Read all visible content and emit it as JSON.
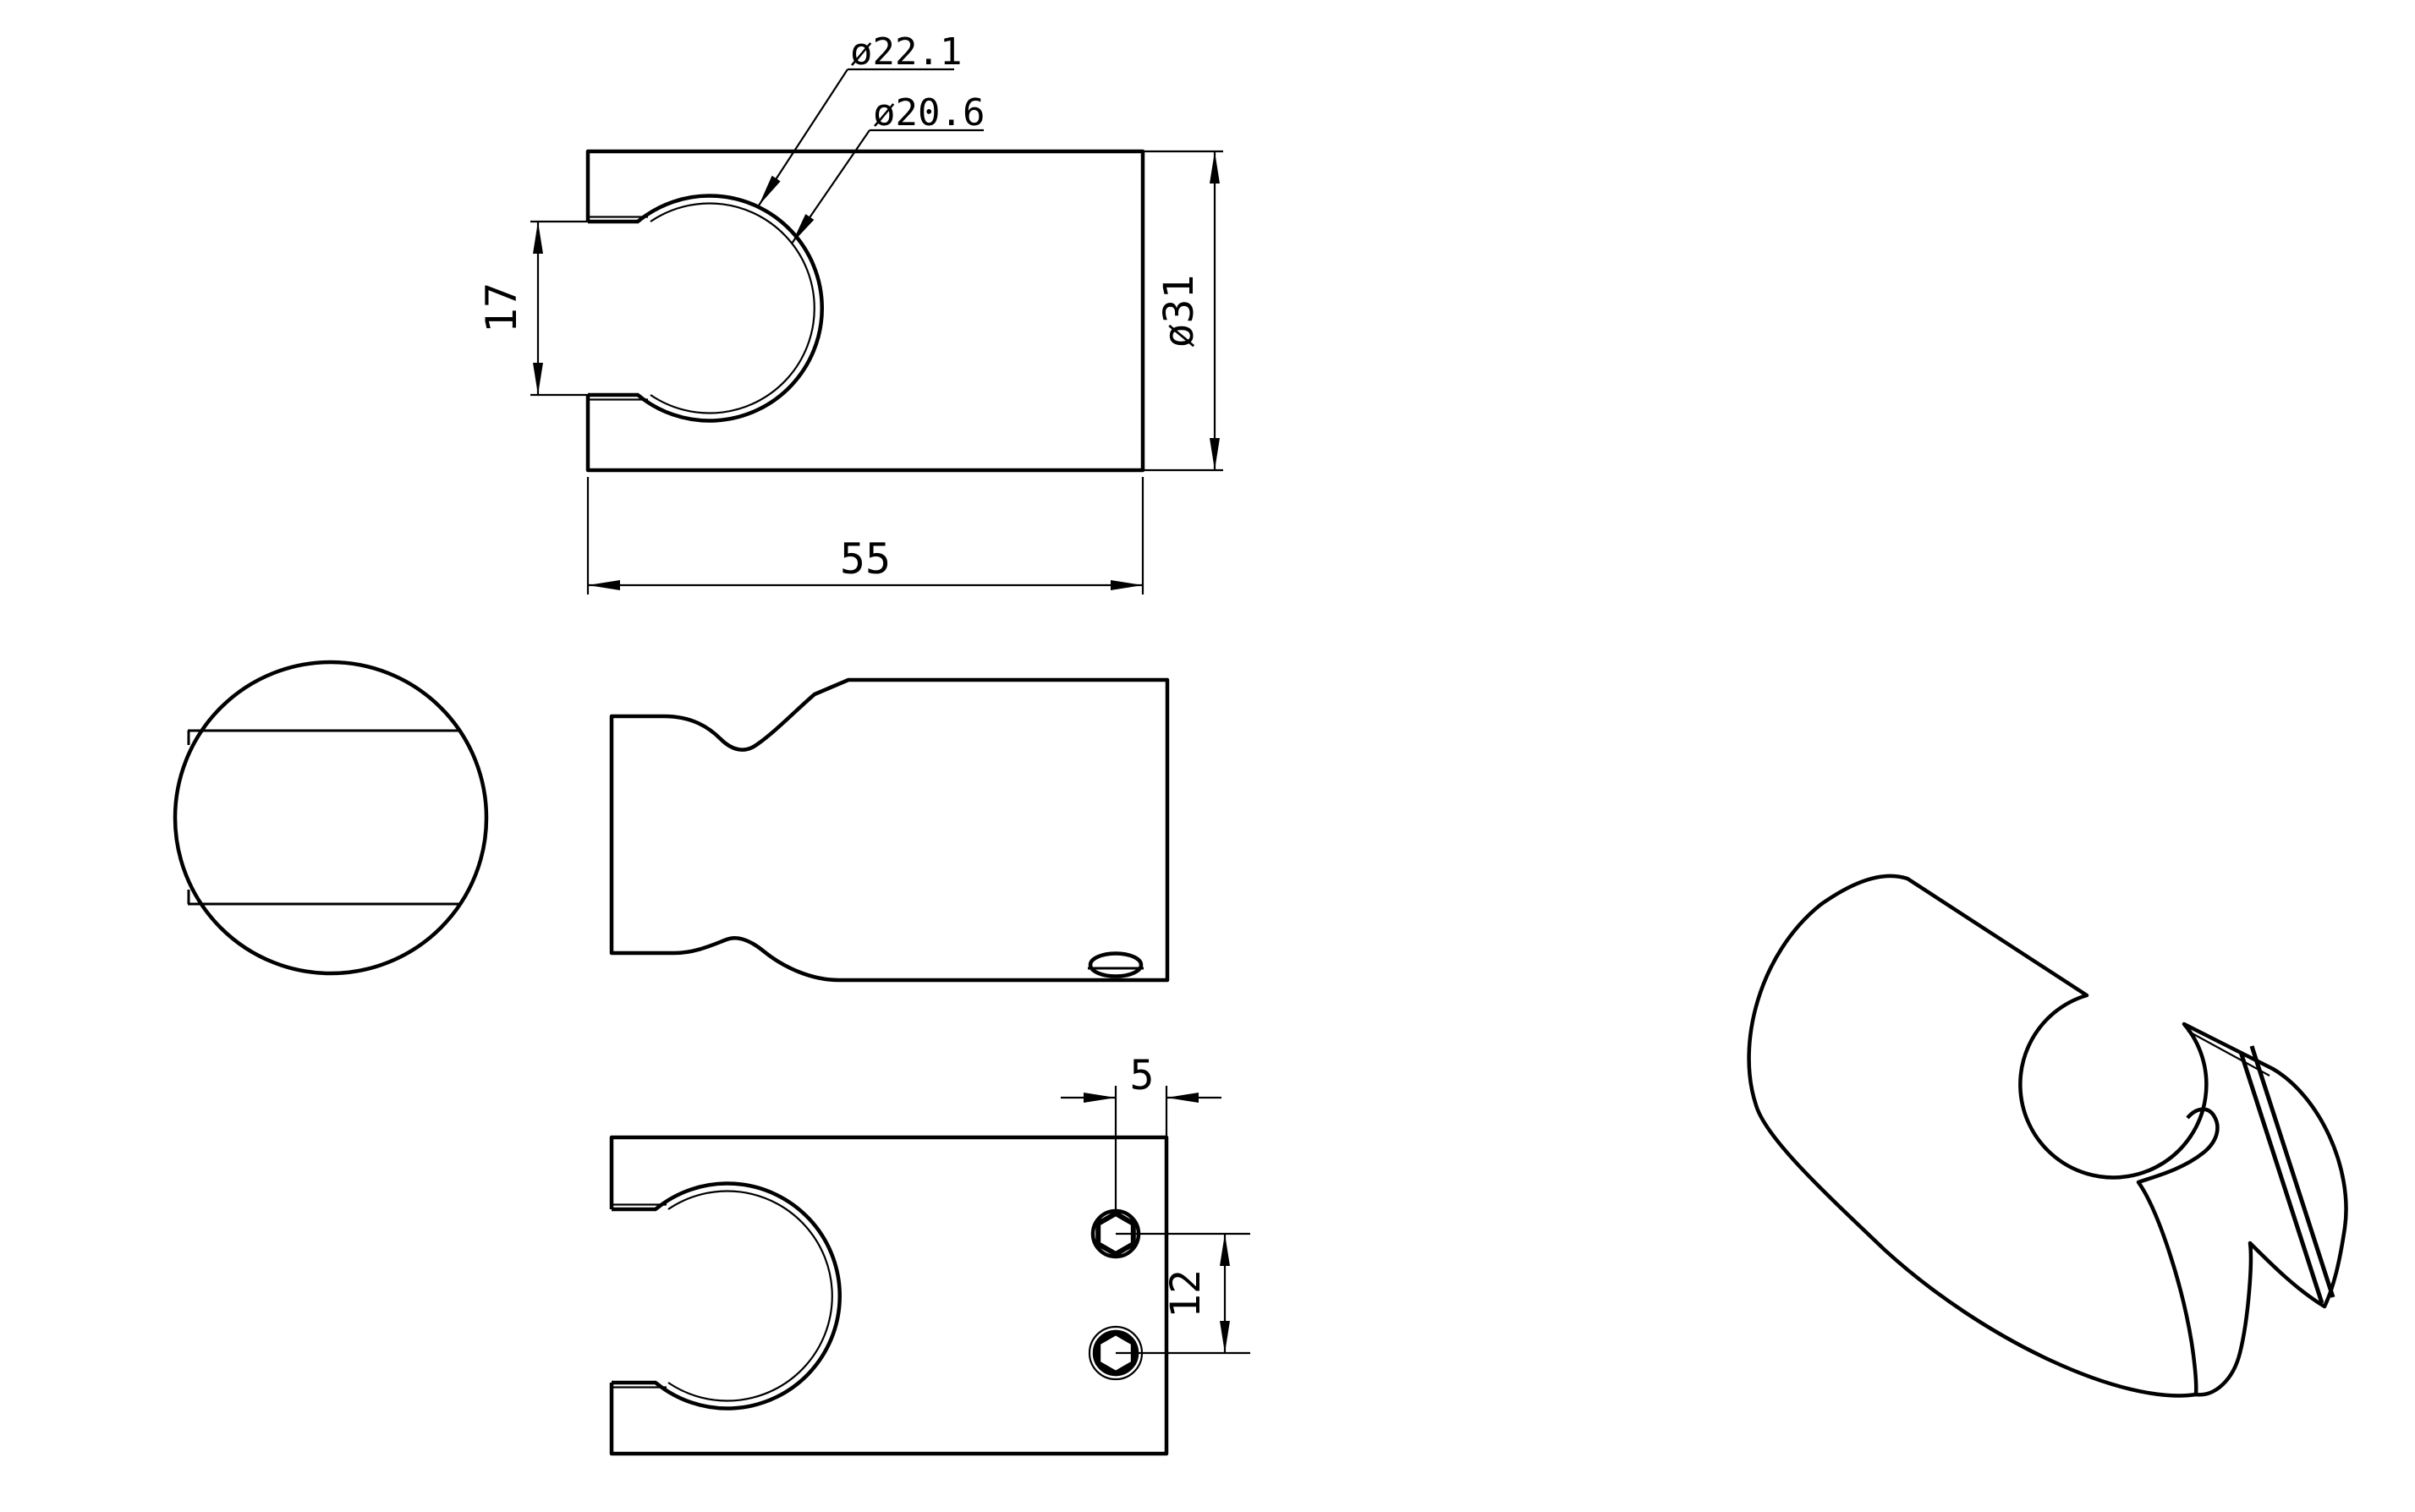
{
  "drawing": {
    "type": "cad-orthographic-technical-drawing",
    "subject": "hand-shower wall holder bracket",
    "colors": {
      "line": "#000000",
      "background": "#ffffff"
    },
    "labels": {
      "dia_outer": "ø22.1",
      "dia_inner": "ø20.6",
      "slot_width": "17",
      "dia_body": "ø31",
      "body_length": "55",
      "screw_edge_offset": "5",
      "screw_spacing": "12"
    },
    "views": {
      "front": "front view with keyhole clamp opening",
      "end": "end view circle with slot chords",
      "side": "side profile with waist scoop and screw",
      "bottom": "bottom view with U-cutout and two hex socket screws",
      "isometric": "isometric pictorial view"
    }
  }
}
